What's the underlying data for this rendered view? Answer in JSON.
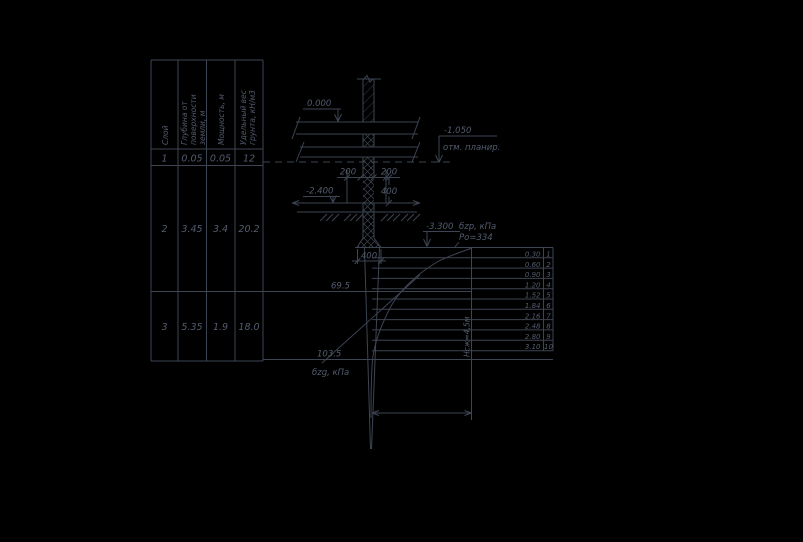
{
  "drawing": {
    "colors": {
      "background": "#000000",
      "line": "#3d4452",
      "text": "#535c6e"
    },
    "soil_table": {
      "headers": [
        {
          "lines": [
            "Слой"
          ]
        },
        {
          "lines": [
            "Глубина от",
            "поверхности",
            "земли, м"
          ]
        },
        {
          "lines": [
            "Мощность, м"
          ]
        },
        {
          "lines": [
            "Удельный вес",
            "грунта, кН/м3"
          ]
        }
      ],
      "rows": [
        {
          "layer": "1",
          "depth": "0.05",
          "thickness": "0.05",
          "unit_weight": "12"
        },
        {
          "layer": "2",
          "depth": "3.45",
          "thickness": "3.4",
          "unit_weight": "20.2"
        },
        {
          "layer": "3",
          "depth": "5.35",
          "thickness": "1.9",
          "unit_weight": "18.0"
        }
      ]
    },
    "levels": {
      "zero": "0.000",
      "planning": "-1.050",
      "planning_note": "отм. планир.",
      "footing_bottom": "-2.400",
      "pile_base": "-3.300"
    },
    "dimensions": {
      "left_offset": "200",
      "right_offset": "200",
      "footing_height": "400",
      "pile_width": "400"
    },
    "pressure": {
      "sigma_zp_label": "бzp, кПа",
      "po_label": "Ро=334",
      "sigma_zg_label": "бzg, кПа",
      "sigma_zg_layer2": "69.5",
      "sigma_zg_bottom": "103.5",
      "compressible_depth": "Нсж=4,5м"
    },
    "depth_scale": {
      "values": [
        "0.30",
        "0.60",
        "0.90",
        "1.20",
        "1.52",
        "1.84",
        "2.16",
        "2.48",
        "2.80",
        "3.10"
      ],
      "indices": [
        "1",
        "2",
        "3",
        "4",
        "5",
        "6",
        "7",
        "8",
        "9",
        "10"
      ]
    }
  }
}
